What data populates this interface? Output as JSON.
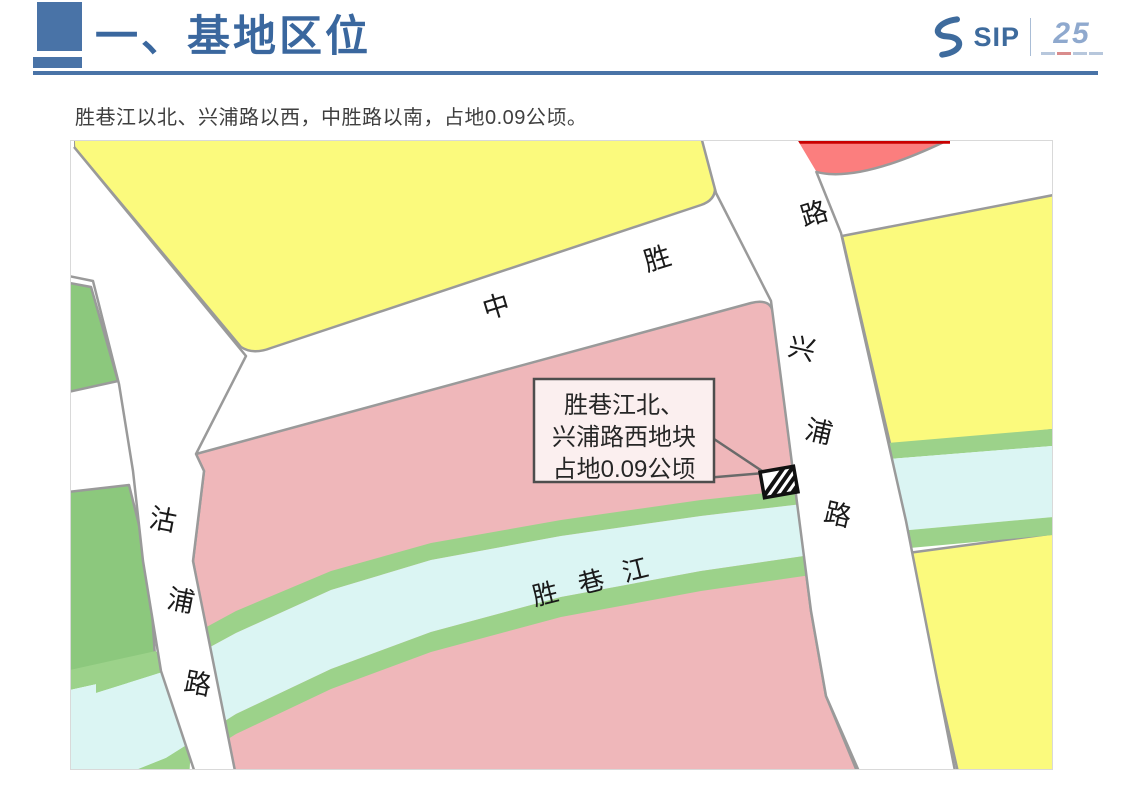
{
  "header": {
    "title": "一、基地区位"
  },
  "logo": {
    "sip": "SIP",
    "anniversary": "25"
  },
  "intro": {
    "text": "胜巷江以北、兴浦路以西，中胜路以南，占地0.09公顷。"
  },
  "map": {
    "roads": {
      "zhongsheng": [
        "中",
        "胜",
        "路"
      ],
      "xingpu": [
        "兴",
        "浦",
        "路"
      ],
      "gupu": [
        "沽",
        "浦",
        "路"
      ]
    },
    "river": [
      "胜",
      "巷",
      "江"
    ],
    "callout": {
      "line1": "胜巷江北、",
      "line2": "兴浦路西地块",
      "line3": "占地0.09公顷"
    },
    "colors": {
      "parcel_yellow": "#FBFA7D",
      "parcel_pink": "#EFB7BA",
      "parcel_red": "#FB7E7E",
      "parcel_green": "#8CC87D",
      "river_bank_green": "#9CD28A",
      "river_water": "#DBF5F3",
      "road_border": "#9A9A9A",
      "accent_blue": "#4973A7",
      "title_blue": "#3A679E"
    }
  }
}
